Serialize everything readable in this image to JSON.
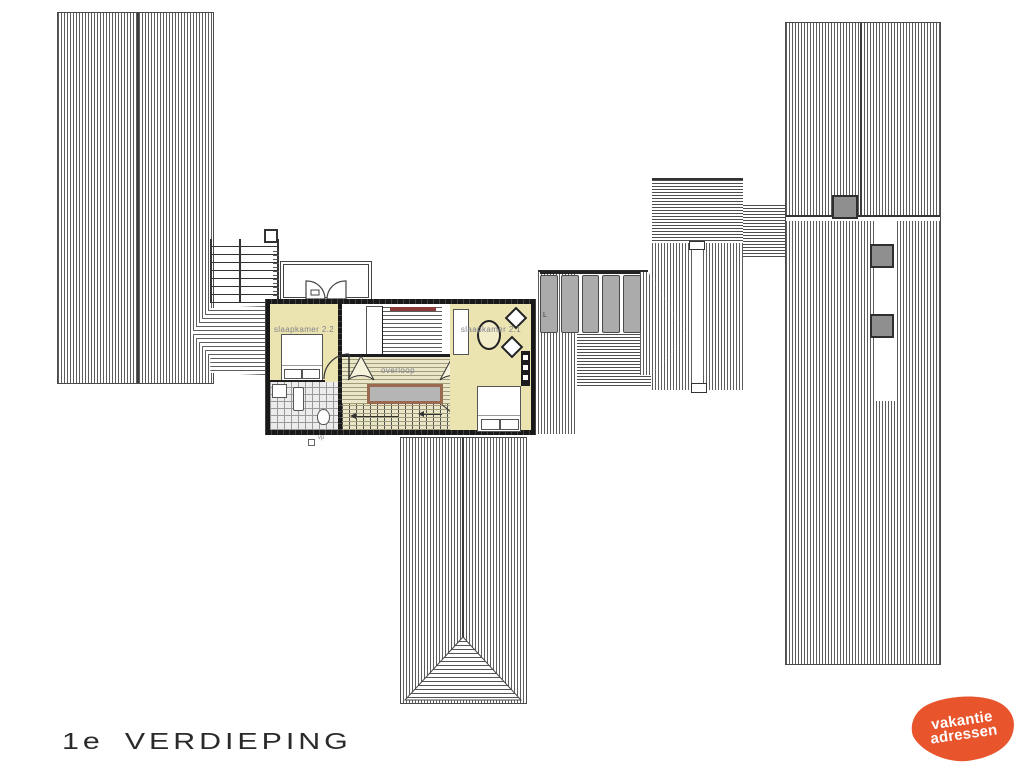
{
  "plan": {
    "rooms": [
      {
        "id": "bedroom-2-2",
        "label": "slaapkamer 2.2"
      },
      {
        "id": "bedroom-2-1",
        "label": "slaapkamer 2.1"
      },
      {
        "id": "landing",
        "label": "overloop"
      }
    ],
    "annotations": {
      "panel_letter": "L",
      "vp_note": "vp"
    },
    "colors": {
      "room_fill": "#ece4b0",
      "stair_void_fill": "#b5b5b5",
      "stair_void_border": "#9a6a50",
      "accent_red": "#8c3b3b",
      "panel_gray": "#ababab"
    }
  },
  "footer": {
    "floor_number": "1e",
    "floor_word": "VERDIEPING"
  },
  "logo": {
    "line1": "vakantie",
    "line2": "adressen",
    "background_color": "#e8542c",
    "text_color": "#ffffff"
  }
}
